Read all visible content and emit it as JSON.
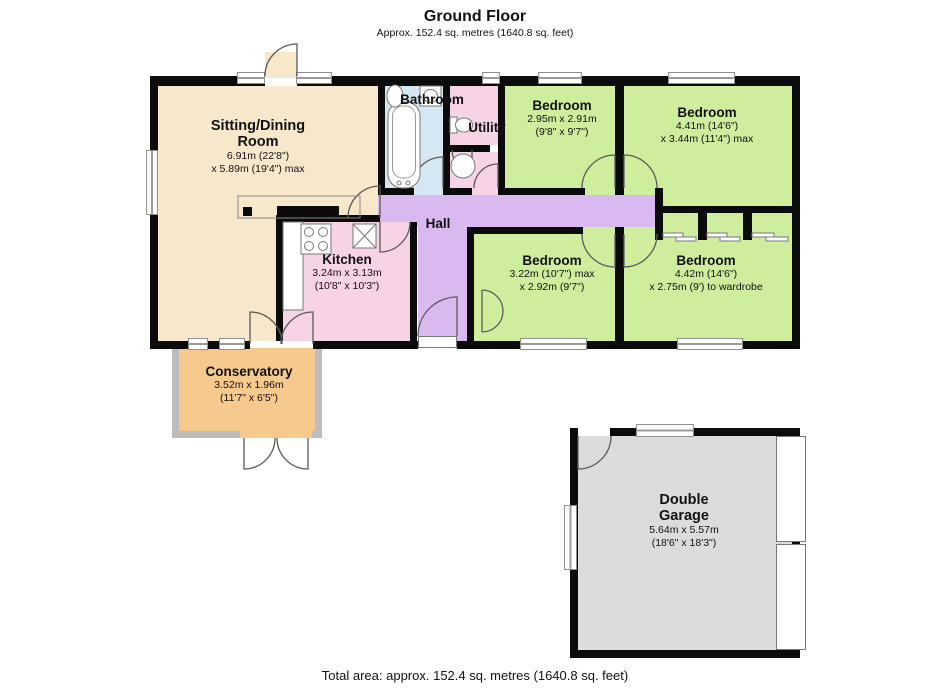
{
  "header": {
    "title": "Ground Floor",
    "subtitle": "Approx. 152.4 sq. metres (1640.8 sq. feet)"
  },
  "footer": {
    "total_area": "Total area: approx. 152.4 sq. metres (1640.8 sq. feet)"
  },
  "rooms": {
    "sitting_dining": {
      "name": "Sitting/Dining\nRoom",
      "dim1": "6.91m (22'8\")",
      "dim2": "x 5.89m (19'4\") max",
      "color": "#f7e7cb"
    },
    "bathroom": {
      "name": "Bathroom",
      "color": "#d4e7f2"
    },
    "utility": {
      "name": "Utility",
      "color": "#f7d3e6"
    },
    "wc": {
      "color": "#f7d3e6"
    },
    "hall": {
      "name": "Hall",
      "color": "#dab9f1"
    },
    "kitchen": {
      "name": "Kitchen",
      "dim1": "3.24m x 3.13m",
      "dim2": "(10'8\" x 10'3\")",
      "color": "#f7d3e6"
    },
    "bedroom1": {
      "name": "Bedroom",
      "dim1": "2.95m x 2.91m",
      "dim2": "(9'8\" x 9'7\")",
      "color": "#cfee9d"
    },
    "bedroom2": {
      "name": "Bedroom",
      "dim1": "4.41m (14'6\")",
      "dim2": "x 3.44m (11'4\") max",
      "color": "#cfee9d"
    },
    "bedroom3": {
      "name": "Bedroom",
      "dim1": "3.22m (10'7\") max",
      "dim2": "x 2.92m (9'7\")",
      "color": "#cfee9d"
    },
    "bedroom4": {
      "name": "Bedroom",
      "dim1": "4.42m (14'6\")",
      "dim2": "x 2.75m (9') to wardrobe",
      "color": "#cfee9d"
    },
    "conservatory": {
      "name": "Conservatory",
      "dim1": "3.52m x 1.96m",
      "dim2": "(11'7\" x 6'5\")",
      "color": "#f6ca8c"
    },
    "garage": {
      "name": "Double\nGarage",
      "dim1": "5.64m x 5.57m",
      "dim2": "(18'6\" x 18'3\")",
      "color": "#dcdcdc"
    }
  },
  "colors": {
    "walls": "#0b0b0b",
    "window_frame": "#8f8f8f",
    "conservatory_frame": "#bcbcbc"
  }
}
